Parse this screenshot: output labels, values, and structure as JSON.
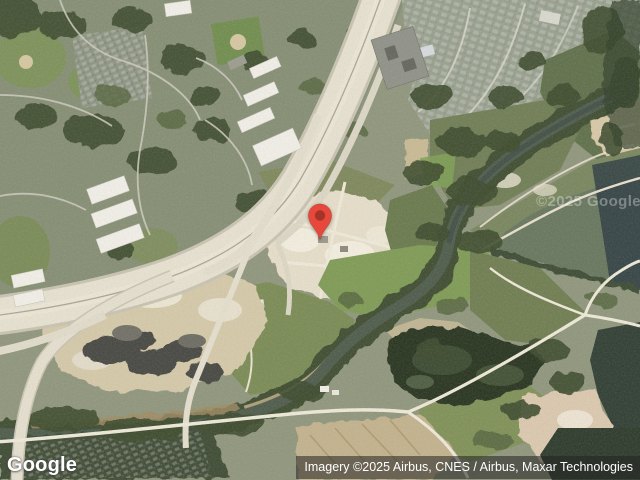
{
  "branding": {
    "logo_text": "Google"
  },
  "attribution": {
    "text": "Imagery ©2025 Airbus, CNES / Airbus, Maxar Technologies"
  },
  "map": {
    "watermark_text": "©2025 Google",
    "pin": {
      "fill": "#E8473B",
      "dot": "#A23527"
    }
  }
}
